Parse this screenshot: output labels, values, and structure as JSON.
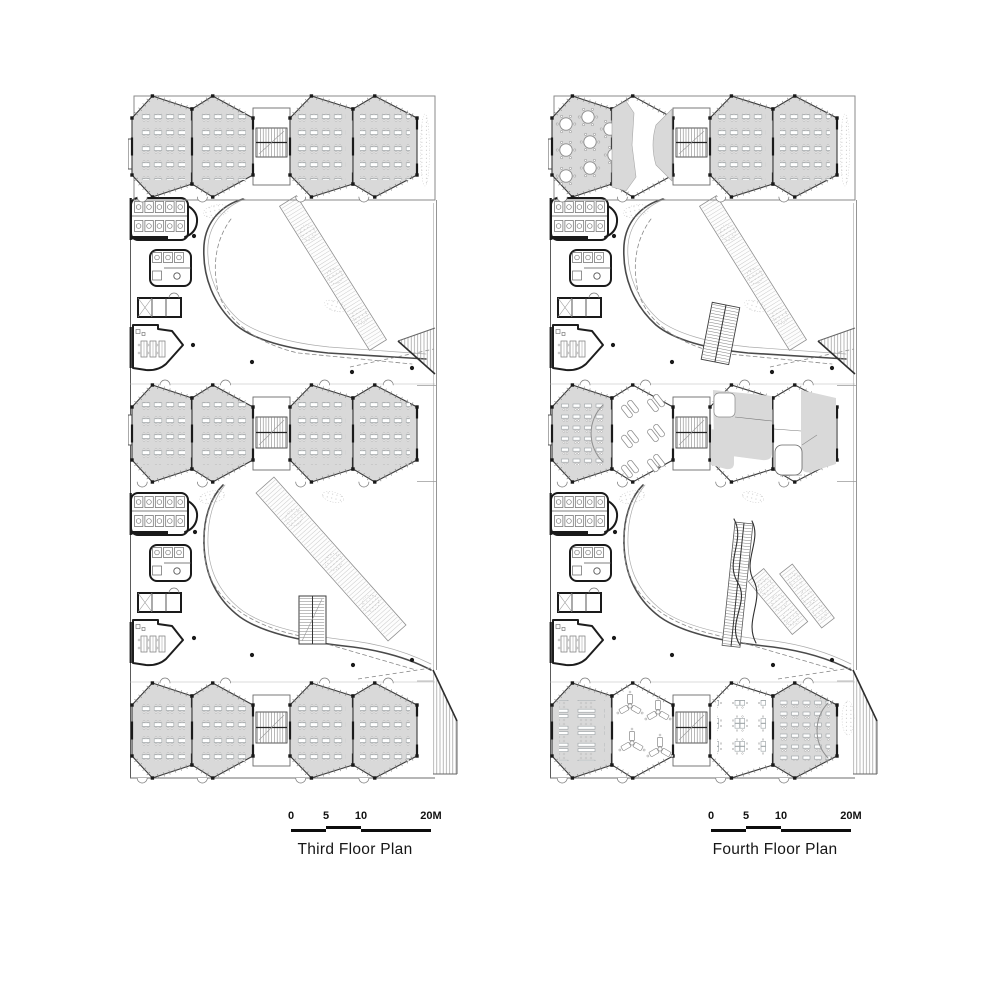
{
  "sheet": {
    "background": "#ffffff"
  },
  "colors": {
    "room_fill": "#d9d9d9",
    "wall": "#1a1a1a",
    "outline": "#3a3a3a",
    "thin_line": "#8c8c8c",
    "furniture": "#9aa0a3",
    "scalebar": "#0d0d0d"
  },
  "plans": [
    {
      "id": "third-floor",
      "title": "Third Floor Plan",
      "scale_bar": {
        "labels": [
          "0",
          "5",
          "10",
          "20M"
        ]
      },
      "bands": [
        {
          "name": "north-classroom-band",
          "rooms": [
            "classroom-desks",
            "classroom-desks",
            "classroom-desks",
            "classroom-desks"
          ]
        },
        {
          "name": "middle-classroom-band",
          "rooms": [
            "classroom-desks",
            "classroom-desks",
            "classroom-desks",
            "classroom-desks"
          ]
        },
        {
          "name": "south-classroom-band",
          "rooms": [
            "classroom-desks",
            "classroom-desks",
            "classroom-desks",
            "classroom-desks"
          ]
        }
      ],
      "atria": [
        {
          "name": "upper-courtyard",
          "stair": "none",
          "ramp": "long-diagonal"
        },
        {
          "name": "lower-courtyard",
          "stair": "switchback",
          "ramp": "long-diagonal"
        }
      ],
      "services": [
        "toilet-block",
        "wc-block",
        "lift-block",
        "office-room"
      ]
    },
    {
      "id": "fourth-floor",
      "title": "Fourth Floor Plan",
      "scale_bar": {
        "labels": [
          "0",
          "5",
          "10",
          "20M"
        ]
      },
      "bands": [
        {
          "name": "north-classroom-band",
          "rooms": [
            "round-tables",
            "open-commons",
            "classroom-desks",
            "classroom-desks"
          ]
        },
        {
          "name": "middle-classroom-band",
          "rooms": [
            "lecture-rows",
            "loungers",
            "partitioned-studio",
            "partitioned-studio"
          ]
        },
        {
          "name": "south-classroom-band",
          "rooms": [
            "bench-desks",
            "y-table-clusters",
            "grouped-tables",
            "lecture-rows"
          ]
        }
      ],
      "atria": [
        {
          "name": "upper-courtyard",
          "stair": "slant",
          "ramp": "long-diagonal"
        },
        {
          "name": "lower-courtyard",
          "stair": "wavy",
          "ramp": "twin-short"
        }
      ],
      "services": [
        "toilet-block",
        "wc-block",
        "lift-block",
        "office-room"
      ]
    }
  ]
}
